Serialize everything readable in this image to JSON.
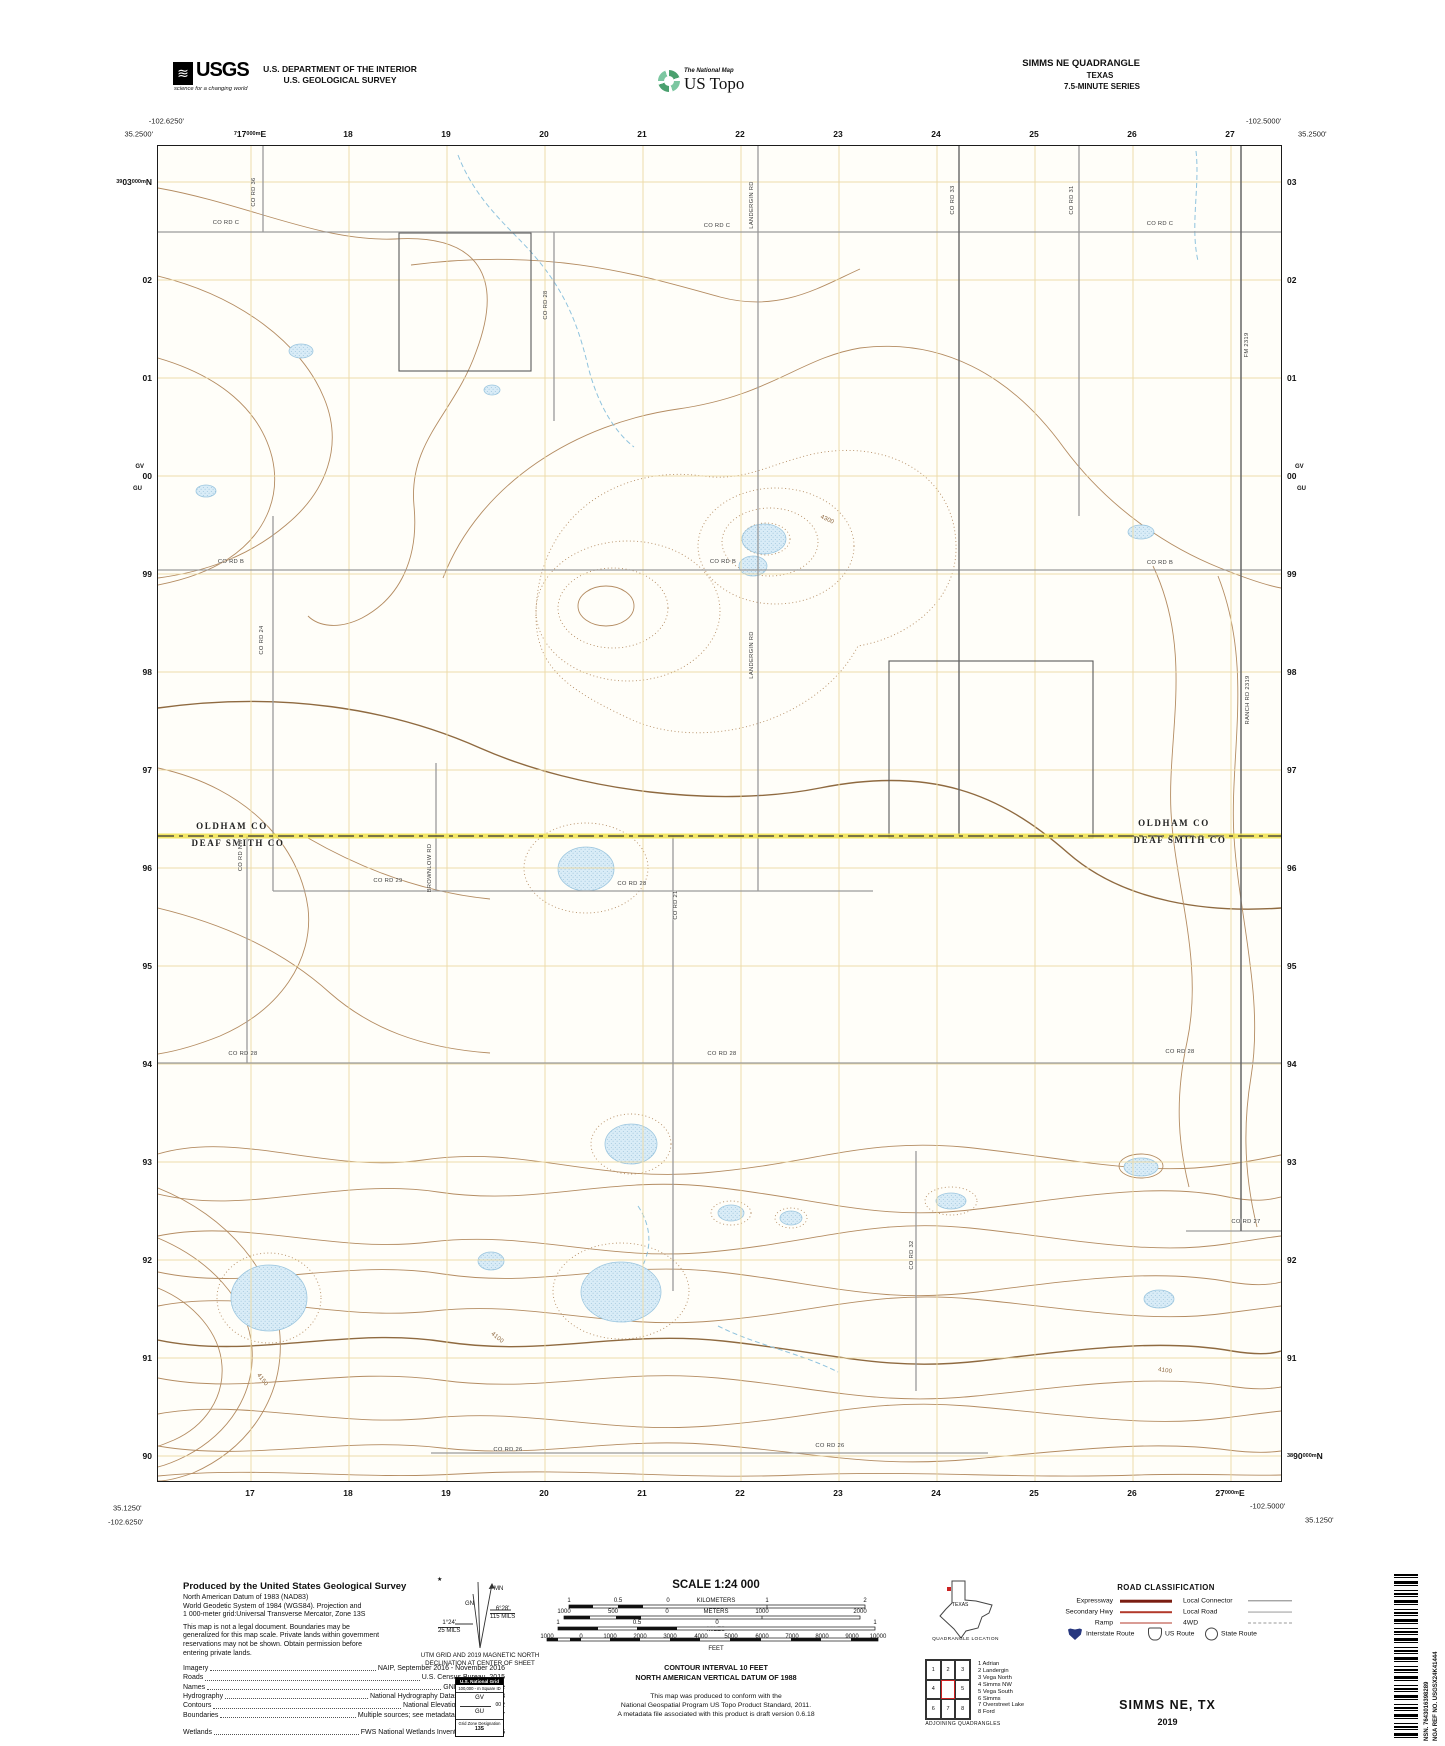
{
  "header": {
    "usgs_acronym": "USGS",
    "usgs_tagline": "science for a changing world",
    "dept1": "U.S. DEPARTMENT OF THE INTERIOR",
    "dept2": "U.S. GEOLOGICAL SURVEY",
    "tnm": "The National Map",
    "ustopo": "US Topo",
    "quad_name": "SIMMS NE QUADRANGLE",
    "quad_state": "TEXAS",
    "quad_series": "7.5-MINUTE SERIES"
  },
  "map": {
    "corners": [
      {
        "t": "-102.6250'",
        "x": 184,
        "y": 121,
        "a": "r"
      },
      {
        "t": "35.2500'",
        "x": 153,
        "y": 134,
        "a": "r"
      },
      {
        "t": "-102.5000'",
        "x": 1246,
        "y": 121,
        "a": "l"
      },
      {
        "t": "35.2500'",
        "x": 1298,
        "y": 134,
        "a": "l"
      },
      {
        "t": "35.1250'",
        "x": 113,
        "y": 1508,
        "a": "l"
      },
      {
        "t": "-102.6250'",
        "x": 108,
        "y": 1522,
        "a": "l"
      },
      {
        "t": "-102.5000'",
        "x": 1250,
        "y": 1506,
        "a": "l"
      },
      {
        "t": "35.1250'",
        "x": 1305,
        "y": 1520,
        "a": "l"
      }
    ],
    "grid_top": [
      {
        "p": "7",
        "b": "17",
        "s": "000m",
        "u": "E"
      },
      "18",
      "19",
      "20",
      "21",
      "22",
      "23",
      "24",
      "25",
      "26",
      "27"
    ],
    "grid_bottom": [
      "17",
      "18",
      "19",
      "20",
      "21",
      "22",
      "23",
      "24",
      "25",
      "26",
      {
        "b": "27",
        "s": "000m",
        "u": "E"
      }
    ],
    "grid_left": [
      {
        "p": "39",
        "b": "03",
        "s": "000m",
        "u": "N"
      },
      "02",
      "01",
      "00",
      "99",
      "98",
      "97",
      "96",
      "95",
      "94",
      "93",
      "92",
      "91",
      "90"
    ],
    "grid_right": [
      "03",
      "02",
      "01",
      "00",
      "99",
      "98",
      "97",
      "96",
      "95",
      "94",
      "93",
      "92",
      "91",
      {
        "p": "38",
        "b": "90",
        "s": "000m",
        "u": "N"
      }
    ],
    "square_ids": {
      "above": "GV",
      "below": "GU"
    },
    "labels": [
      {
        "t": "CO RD C",
        "x": 226,
        "y": 223,
        "r": 0,
        "c": "r"
      },
      {
        "t": "CO RD C",
        "x": 717,
        "y": 226,
        "r": 0,
        "c": "r"
      },
      {
        "t": "CO RD C",
        "x": 1160,
        "y": 224,
        "r": 0,
        "c": "r"
      },
      {
        "t": "CO RD 36",
        "x": 254,
        "y": 192,
        "r": -90,
        "c": "r"
      },
      {
        "t": "CO RD 28",
        "x": 546,
        "y": 305,
        "r": -90,
        "c": "r"
      },
      {
        "t": "LANDERGIN RD",
        "x": 752,
        "y": 205,
        "r": -90,
        "c": "r"
      },
      {
        "t": "CO RD 33",
        "x": 953,
        "y": 200,
        "r": -90,
        "c": "r"
      },
      {
        "t": "CO RD 31",
        "x": 1072,
        "y": 200,
        "r": -90,
        "c": "r"
      },
      {
        "t": "FM 2319",
        "x": 1247,
        "y": 345,
        "r": -90,
        "c": "r"
      },
      {
        "t": "CO RD B",
        "x": 231,
        "y": 562,
        "r": 0,
        "c": "r"
      },
      {
        "t": "CO RD B",
        "x": 723,
        "y": 562,
        "r": 0,
        "c": "r"
      },
      {
        "t": "CO RD B",
        "x": 1160,
        "y": 563,
        "r": 0,
        "c": "r"
      },
      {
        "t": "CO RD 24",
        "x": 262,
        "y": 640,
        "r": -90,
        "c": "r"
      },
      {
        "t": "LANDERGIN RD",
        "x": 752,
        "y": 655,
        "r": -90,
        "c": "r"
      },
      {
        "t": "RANCH RD 2319",
        "x": 1248,
        "y": 700,
        "r": -90,
        "c": "r"
      },
      {
        "t": "4300",
        "x": 827,
        "y": 520,
        "r": 25,
        "c": "c"
      },
      {
        "t": "OLDHAM CO",
        "x": 232,
        "y": 826,
        "r": 0,
        "c": "y"
      },
      {
        "t": "DEAF SMITH CO",
        "x": 238,
        "y": 843,
        "r": 0,
        "c": "y"
      },
      {
        "t": "OLDHAM CO",
        "x": 1174,
        "y": 823,
        "r": 0,
        "c": "y"
      },
      {
        "t": "DEAF SMITH CO",
        "x": 1180,
        "y": 840,
        "r": 0,
        "c": "y"
      },
      {
        "t": "CO RD 29",
        "x": 388,
        "y": 881,
        "r": 0,
        "c": "r"
      },
      {
        "t": "CO RD 28",
        "x": 632,
        "y": 884,
        "r": 0,
        "c": "r"
      },
      {
        "t": "BROWNLOW RD",
        "x": 430,
        "y": 868,
        "r": -90,
        "c": "r"
      },
      {
        "t": "CO RD NW",
        "x": 241,
        "y": 855,
        "r": -90,
        "c": "r"
      },
      {
        "t": "CO RD 21",
        "x": 676,
        "y": 905,
        "r": -90,
        "c": "r"
      },
      {
        "t": "CO RD 28",
        "x": 243,
        "y": 1054,
        "r": 0,
        "c": "r"
      },
      {
        "t": "CO RD 28",
        "x": 722,
        "y": 1054,
        "r": 0,
        "c": "r"
      },
      {
        "t": "CO RD 28",
        "x": 1180,
        "y": 1052,
        "r": 0,
        "c": "r"
      },
      {
        "t": "CO RD 27",
        "x": 1246,
        "y": 1222,
        "r": 0,
        "c": "r"
      },
      {
        "t": "CO RD 32",
        "x": 912,
        "y": 1255,
        "r": -90,
        "c": "r"
      },
      {
        "t": "CO RD 26",
        "x": 508,
        "y": 1450,
        "r": 0,
        "c": "r"
      },
      {
        "t": "CO RD 26",
        "x": 830,
        "y": 1446,
        "r": 0,
        "c": "r"
      },
      {
        "t": "4150",
        "x": 262,
        "y": 1380,
        "r": 52,
        "c": "c"
      },
      {
        "t": "4100",
        "x": 497,
        "y": 1338,
        "r": 40,
        "c": "c"
      },
      {
        "t": "4100",
        "x": 1165,
        "y": 1371,
        "r": 8,
        "c": "c"
      }
    ]
  },
  "footer": {
    "produced": {
      "title": "Produced by the United States Geological Survey",
      "lines": [
        "North American Datum of 1983 (NAD83)",
        "World Geodetic System of 1984 (WGS84).  Projection and",
        "1 000-meter grid:Universal Transverse Mercator, Zone 13S",
        "This map is not a legal document. Boundaries may be",
        "generalized for this map scale. Private lands within government",
        "reservations may not be shown. Obtain permission before",
        "entering private lands."
      ],
      "sources": [
        [
          "Imagery",
          "NAIP, September 2016 - November 2016"
        ],
        [
          "Roads",
          "U.S. Census Bureau, 2015"
        ],
        [
          "Names",
          "GNIS, Not Available"
        ],
        [
          "Hydrography",
          "National Hydrography Dataset, 2003 - 2018"
        ],
        [
          "Contours",
          "National Elevation Dataset, 2002"
        ],
        [
          "Boundaries",
          "Multiple sources; see metadata file 2016 - 2017"
        ],
        [
          "Wetlands",
          "FWS National Wetlands Inventory 2003 - 2005"
        ]
      ]
    },
    "declination": {
      "star": "★",
      "mn": "MN",
      "gn": "GN",
      "gn_deg": "1°24'",
      "gn_mils": "25 MILS",
      "mn_deg": "6°28'",
      "mn_mils": "115 MILS",
      "caption1": "UTM GRID AND 2019 MAGNETIC NORTH",
      "caption2": "DECLINATION AT CENTER OF SHEET"
    },
    "usng": {
      "title": "U.S. National Grid",
      "sub": "100,000 - m Square ID",
      "gv": "GV",
      "zeros": "00",
      "gu": "GU",
      "f1": "Grid Zone Designation",
      "f2": "13S"
    },
    "scale": {
      "title": "SCALE 1:24 000",
      "rows": [
        {
          "y": 1601,
          "ticks": [
            [
              "1",
              569
            ],
            [
              "0.5",
              618
            ],
            [
              "0",
              668
            ],
            [
              "KILOMETERS",
              716
            ],
            [
              "1",
              767
            ],
            [
              "2",
              865
            ]
          ]
        },
        {
          "y": 1612,
          "ticks": [
            [
              "1000",
              564
            ],
            [
              "500",
              613
            ],
            [
              "0",
              667
            ],
            [
              "METERS",
              716
            ],
            [
              "1000",
              762
            ],
            [
              "2000",
              860
            ]
          ]
        },
        {
          "y": 1623,
          "ticks": [
            [
              "1",
              558
            ],
            [
              "0.5",
              637
            ],
            [
              "0",
              717
            ],
            [
              "1",
              875
            ]
          ]
        },
        {
          "y": 1637,
          "ticks": [
            [
              "1000",
              547
            ],
            [
              "0",
              581
            ],
            [
              "1000",
              610
            ],
            [
              "2000",
              640
            ],
            [
              "3000",
              670
            ],
            [
              "4000",
              701
            ],
            [
              "5000",
              731
            ],
            [
              "6000",
              762
            ],
            [
              "7000",
              792
            ],
            [
              "8000",
              822
            ],
            [
              "9000",
              852
            ],
            [
              "10000",
              878
            ]
          ]
        }
      ],
      "captions": [
        [
          "MILES",
          716,
          1630
        ],
        [
          "FEET",
          716,
          1649
        ]
      ]
    },
    "interval1": "CONTOUR INTERVAL 10 FEET",
    "interval2": "NORTH AMERICAN VERTICAL DATUM OF 1988",
    "conform": [
      "This map was produced to conform with the",
      "National Geospatial Program US Topo Product Standard, 2011.",
      "A metadata file associated with this product is draft version 0.6.18"
    ],
    "location": {
      "state_label": "TEXAS",
      "caption": "QUADRANGLE LOCATION"
    },
    "adjoining": {
      "cells": [
        "1",
        "2",
        "3",
        "4",
        "",
        "5",
        "6",
        "7",
        "8"
      ],
      "names": [
        "1 Adrian",
        "2 Landergin",
        "3 Vega North",
        "4 Simms NW",
        "5 Vega South",
        "6 Simms",
        "7 Overstreet Lake",
        "8 Ford"
      ],
      "caption": "ADJOINING QUADRANGLES"
    },
    "road_class": {
      "title": "ROAD CLASSIFICATION",
      "rows": [
        {
          "lt": "Expressway",
          "ls": "expressway",
          "rt": "Local Connector",
          "rs": "connector"
        },
        {
          "lt": "Secondary Hwy",
          "ls": "secondary",
          "rt": "Local Road",
          "rs": "local"
        },
        {
          "lt": "Ramp",
          "ls": "ramp",
          "rt": "4WD",
          "rs": "fwd"
        }
      ],
      "badges": [
        "Interstate Route",
        "US Route",
        "State Route"
      ]
    },
    "barcode": {
      "l1": "NSN. 7643016398289",
      "l2": "NGA REF NO. USGSX24K41444"
    },
    "title": "SIMMS NE,  TX",
    "year": "2019"
  },
  "colors": {
    "grid": "#ecd9a2",
    "contour": "#b48c62",
    "contour_index": "#8f6a40",
    "water": "#d9ecf7",
    "water_edge": "#9cc6df",
    "road": "#9a9a9a",
    "road_dark": "#666666",
    "county_highlight": "#f0e24d",
    "expressway": "#7a1d12",
    "secondary": "#b33a2b",
    "interstate_shield": "#27377f",
    "quad_marker": "#cc2222",
    "usgs_green": "#4aa06e"
  }
}
